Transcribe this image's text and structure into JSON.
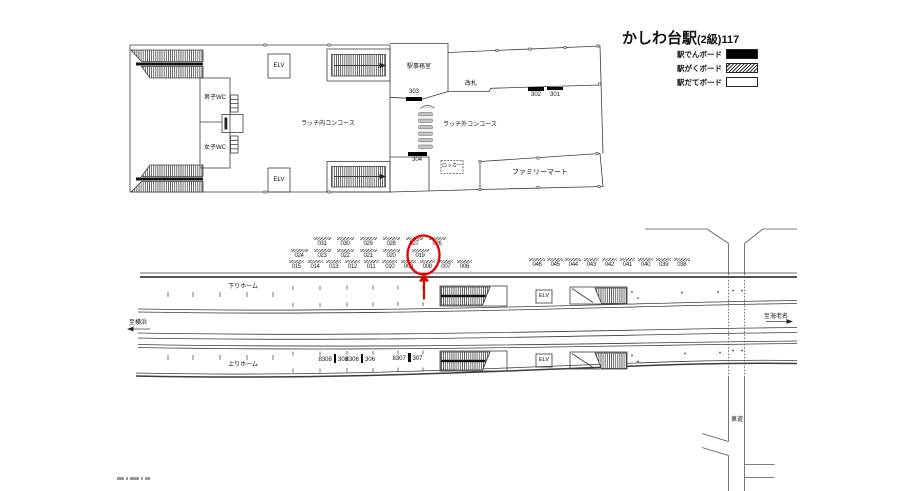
{
  "legend": {
    "station_name": "かしわ台駅",
    "station_grade": "(2級)117",
    "items": [
      {
        "label": "駅でんボード",
        "style": "solid",
        "color": "#000000"
      },
      {
        "label": "駅がくボード",
        "style": "hatched",
        "color": "#ffffff"
      },
      {
        "label": "駅だてボード",
        "style": "open",
        "color": "#ffffff"
      }
    ]
  },
  "concourse": {
    "mens_wc": "男子WC",
    "womens_wc": "女子WC",
    "elevator": "ELV",
    "inner_concourse": "ラッチ内コンコース",
    "station_office": "駅事務室",
    "ticket_gate": "改札",
    "outer_concourse": "ラッチ外コンコース",
    "locker": "ロッカー",
    "family_mart": "ファミリーマート",
    "boards": {
      "b303": "303",
      "b302": "302",
      "b301": "301",
      "b304": "304"
    }
  },
  "platform": {
    "down_platform": "下りホーム",
    "up_platform": "上りホーム",
    "to_yokohama": "至横浜",
    "to_ebina": "至海老名",
    "elevator": "ELV",
    "roadway": "車道",
    "board_rows": {
      "row1": [
        "031",
        "030",
        "029",
        "028",
        "027",
        "026"
      ],
      "row2": [
        "024",
        "023",
        "022",
        "021",
        "020",
        "019"
      ],
      "row3": [
        "015",
        "014",
        "013",
        "012",
        "011",
        "010",
        "009",
        "008",
        "007",
        "006"
      ],
      "row_right": [
        "046",
        "045",
        "044",
        "043",
        "042",
        "041",
        "040",
        "039",
        "038"
      ]
    },
    "pillar_boards": [
      {
        "left": "8308",
        "right": "308"
      },
      {
        "left": "8306",
        "right": "306"
      },
      {
        "left": "8307",
        "right": "307"
      }
    ],
    "highlighted_board": "019",
    "highlight_color": "#e60000"
  }
}
